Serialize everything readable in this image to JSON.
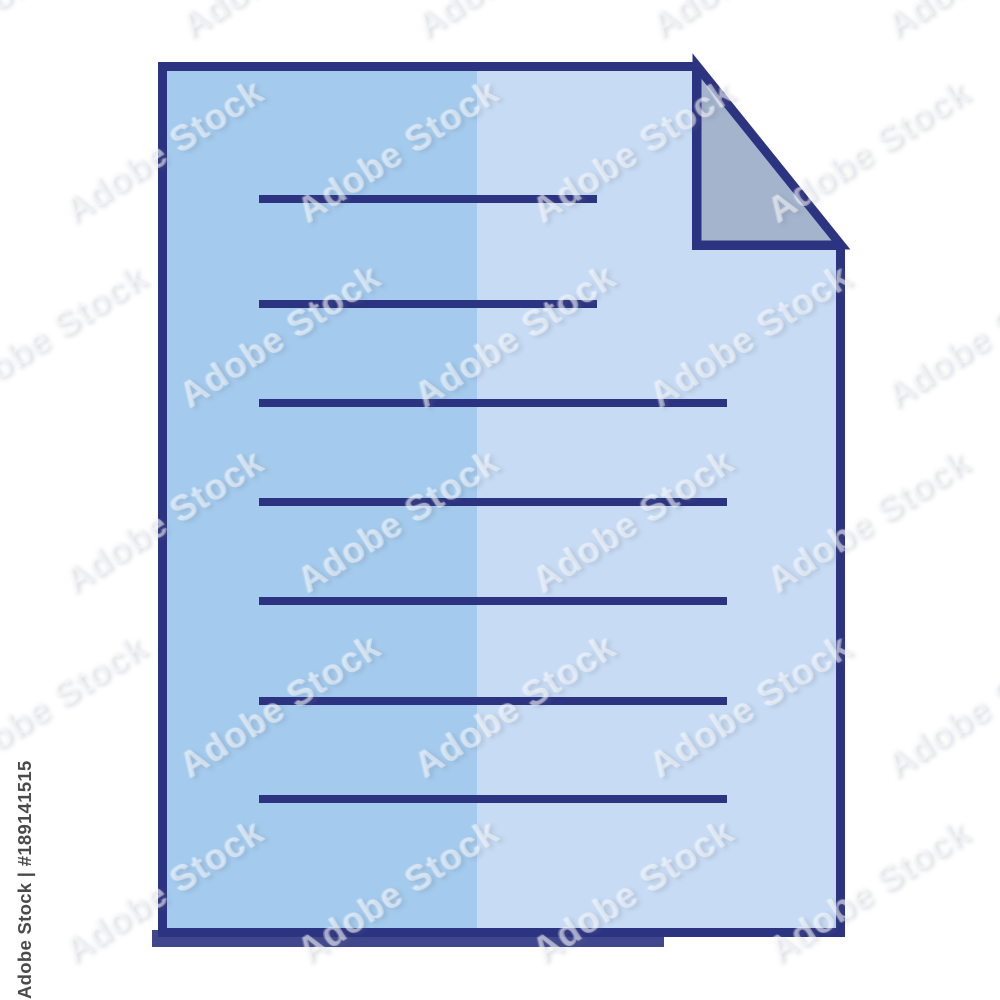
{
  "watermark": {
    "id_text": "Adobe Stock | #189141515",
    "tile_text": "Adobe Stock"
  },
  "icon": {
    "colors": {
      "outline": "#2c3380",
      "page_left": "#a4cbed",
      "page_right": "#c7dcf4",
      "fold": "#a3b4cc",
      "background": "#ffffff",
      "id_text_color": "#4a4a4a"
    },
    "line_thickness": 8,
    "lines": [
      {
        "x1": 259,
        "x2": 597,
        "y": 199
      },
      {
        "x1": 259,
        "x2": 597,
        "y": 304
      },
      {
        "x1": 259,
        "x2": 727,
        "y": 403
      },
      {
        "x1": 259,
        "x2": 727,
        "y": 502
      },
      {
        "x1": 259,
        "x2": 727,
        "y": 601
      },
      {
        "x1": 259,
        "x2": 727,
        "y": 701
      },
      {
        "x1": 259,
        "x2": 727,
        "y": 799
      }
    ]
  }
}
